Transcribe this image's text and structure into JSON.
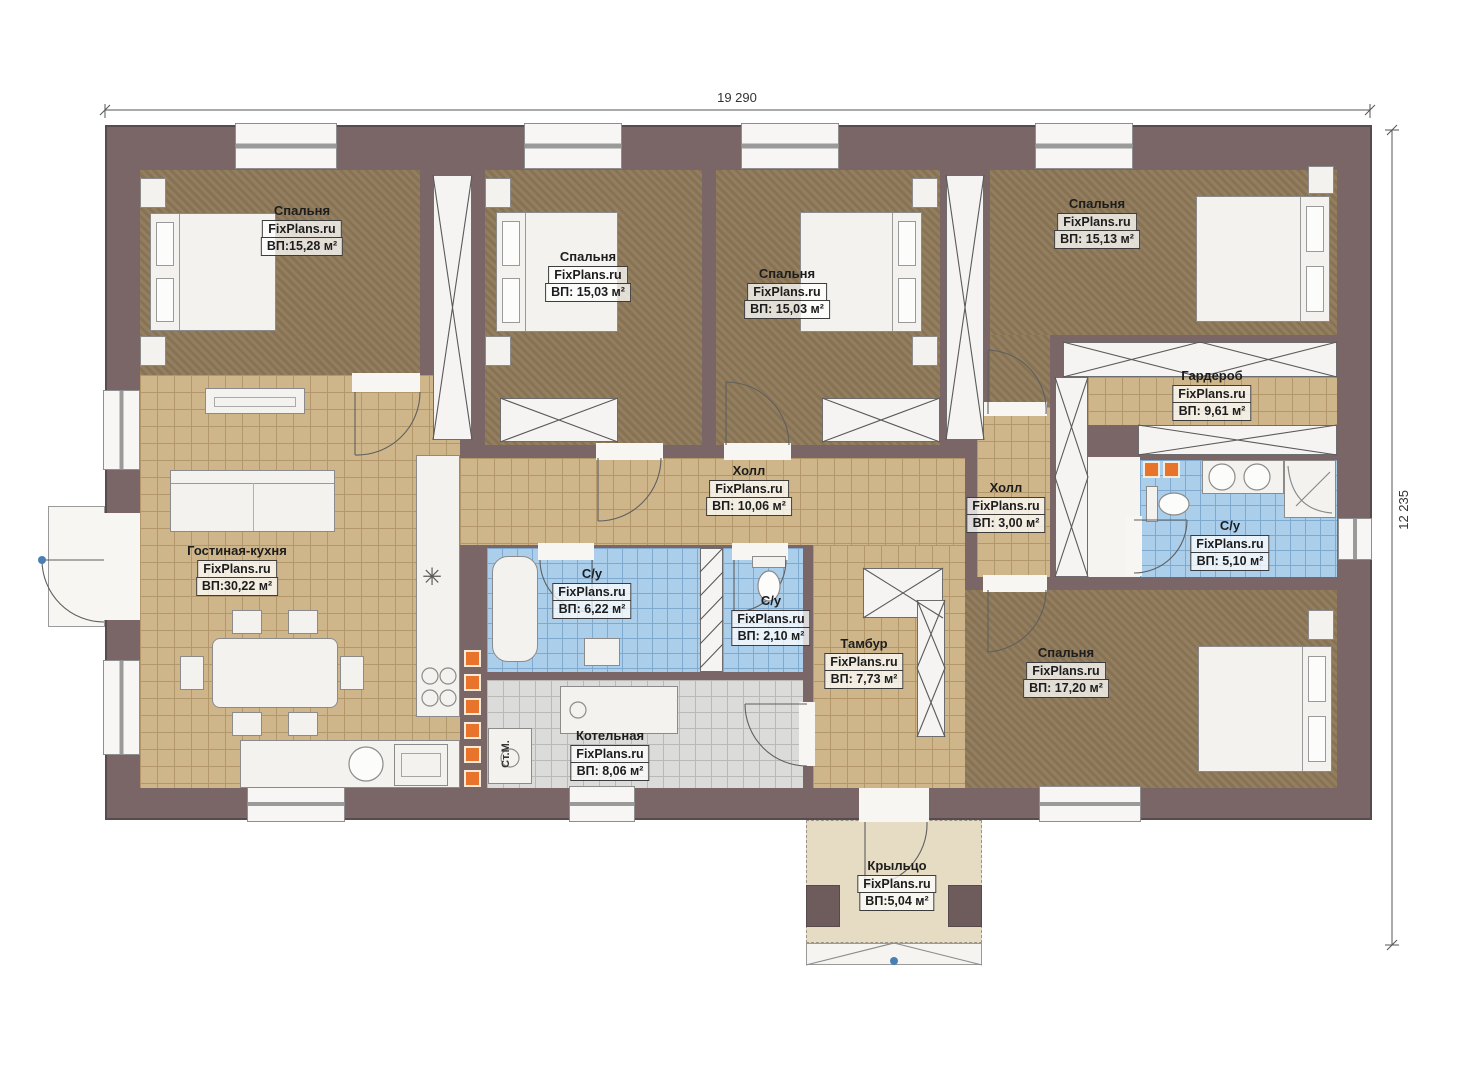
{
  "watermark": "FixPlans.ru",
  "dimensions": {
    "width": "19 290",
    "height": "12 235"
  },
  "rooms": [
    {
      "id": "bedroom-1",
      "name": "Спальня",
      "area": "ВП:15,28 м²"
    },
    {
      "id": "bedroom-2",
      "name": "Спальня",
      "area": "ВП: 15,03 м²"
    },
    {
      "id": "bedroom-3",
      "name": "Спальня",
      "area": "ВП: 15,03 м²"
    },
    {
      "id": "bedroom-4",
      "name": "Спальня",
      "area": "ВП: 15,13 м²"
    },
    {
      "id": "wardrobe",
      "name": "Гардероб",
      "area": "ВП: 9,61 м²"
    },
    {
      "id": "hall-main",
      "name": "Холл",
      "area": "ВП: 10,06 м²"
    },
    {
      "id": "hall-small",
      "name": "Холл",
      "area": "ВП: 3,00 м²"
    },
    {
      "id": "bathroom-master",
      "name": "С/у",
      "area": "ВП: 5,10 м²"
    },
    {
      "id": "living-kitchen",
      "name": "Гостиная-кухня",
      "area": "ВП:30,22 м²"
    },
    {
      "id": "bathroom-main",
      "name": "С/у",
      "area": "ВП: 6,22 м²"
    },
    {
      "id": "bathroom-small",
      "name": "С/у",
      "area": "ВП: 2,10 м²"
    },
    {
      "id": "tambour",
      "name": "Тамбур",
      "area": "ВП: 7,73 м²"
    },
    {
      "id": "bedroom-5",
      "name": "Спальня",
      "area": "ВП: 17,20 м²"
    },
    {
      "id": "boiler-room",
      "name": "Котельная",
      "area": "ВП: 8,06 м²"
    },
    {
      "id": "porch",
      "name": "Крыльцо",
      "area": "ВП:5,04 м²"
    }
  ],
  "labels": {
    "washing_machine": "Ст.М."
  },
  "symbols": {
    "snowflake": "✳"
  },
  "colors": {
    "wall": "#7a6667",
    "bedroom_floor": "#8d7858",
    "tile_floor": "#cfb68a",
    "bath_floor": "#abcfea",
    "boiler_floor": "#dbdbd9",
    "porch_floor": "#e6dcc4",
    "accent_orange": "#e8742c",
    "door_axis_blue": "#4a7fb5"
  }
}
